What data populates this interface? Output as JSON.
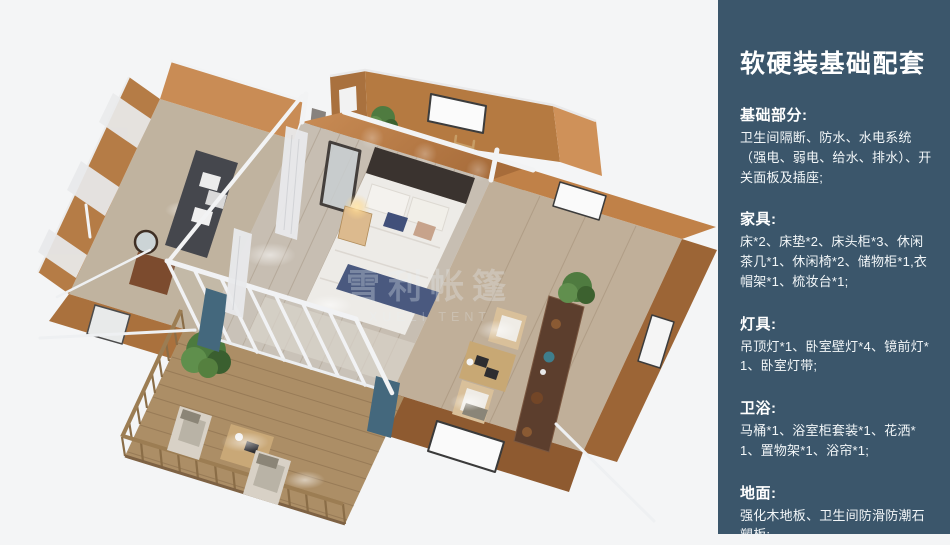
{
  "render": {
    "description": "3D bird's-eye render of a glamping tent house: central bedroom with double bed, left dressing wing with sofa and mirror, top bathroom wing with towel ladder, right lounge corridor with chairs and sideboard, front wooden deck with loungers and railing",
    "watermark": {
      "line1": "雪利帐篷",
      "line2": "XUELI TENT"
    },
    "colors": {
      "background": "#f4f5f6",
      "tent_wall": "#b57a41",
      "wall_light": "#c98c55",
      "wood_floor": "#c7beb2",
      "deck_wood": "#ac8e66",
      "white_frame": "#f2f3f4",
      "bedding": "#edebe7",
      "accent_navy": "#4a597f",
      "curtain_blue": "#44687d",
      "plant_green": "#4f7b40"
    }
  },
  "sidebar": {
    "background": "#3b566b",
    "title": "软硬装基础配套",
    "sections": [
      {
        "heading": "基础部分:",
        "body": "卫生间隔断、防水、水电系统（强电、弱电、给水、排水）、开关面板及插座;"
      },
      {
        "heading": "家具:",
        "body": "床*2、床垫*2、床头柜*3、休闲茶几*1、休闲椅*2、储物柜*1,衣帽架*1、梳妆台*1;"
      },
      {
        "heading": "灯具:",
        "body": "吊顶灯*1、卧室壁灯*4、镜前灯*1、卧室灯带;"
      },
      {
        "heading": "卫浴:",
        "body": "马桶*1、浴室柜套装*1、花洒*1、置物架*1、浴帘*1;"
      },
      {
        "heading": "地面:",
        "body": "强化木地板、卫生间防滑防潮石塑板;"
      }
    ]
  }
}
